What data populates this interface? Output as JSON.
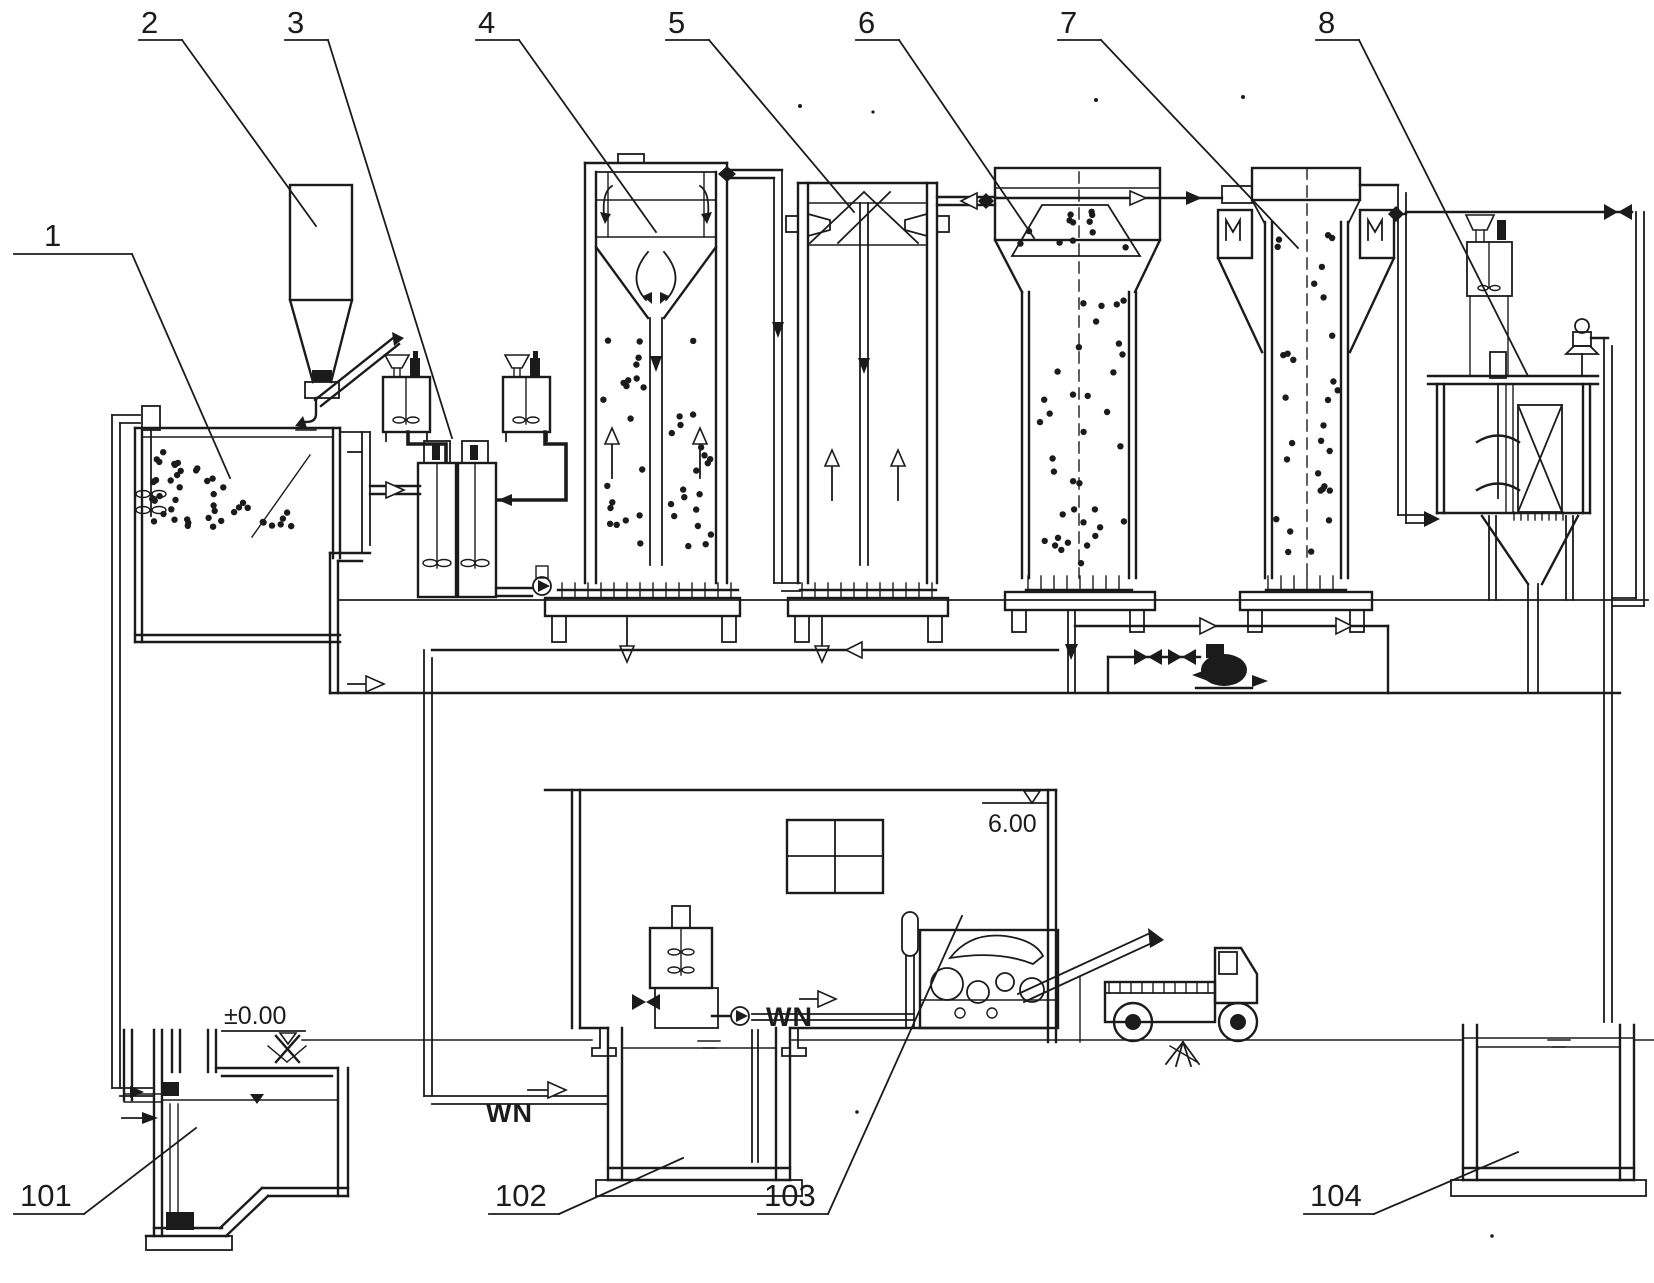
{
  "drawing": {
    "kind": "wastewater-treatment-process-elevation",
    "ink_color": "#1b1b1b",
    "paper_color": "#ffffff"
  },
  "callouts": {
    "top": [
      {
        "id": "1"
      },
      {
        "id": "2"
      },
      {
        "id": "3"
      },
      {
        "id": "4"
      },
      {
        "id": "5"
      },
      {
        "id": "6"
      },
      {
        "id": "7"
      },
      {
        "id": "8"
      }
    ],
    "bottom": [
      {
        "id": "101"
      },
      {
        "id": "102"
      },
      {
        "id": "103"
      },
      {
        "id": "104"
      }
    ]
  },
  "markers": {
    "ground_level": "±0.00",
    "building_level": "6.00",
    "drain_label_left": "WN",
    "drain_label_building": "WN"
  }
}
